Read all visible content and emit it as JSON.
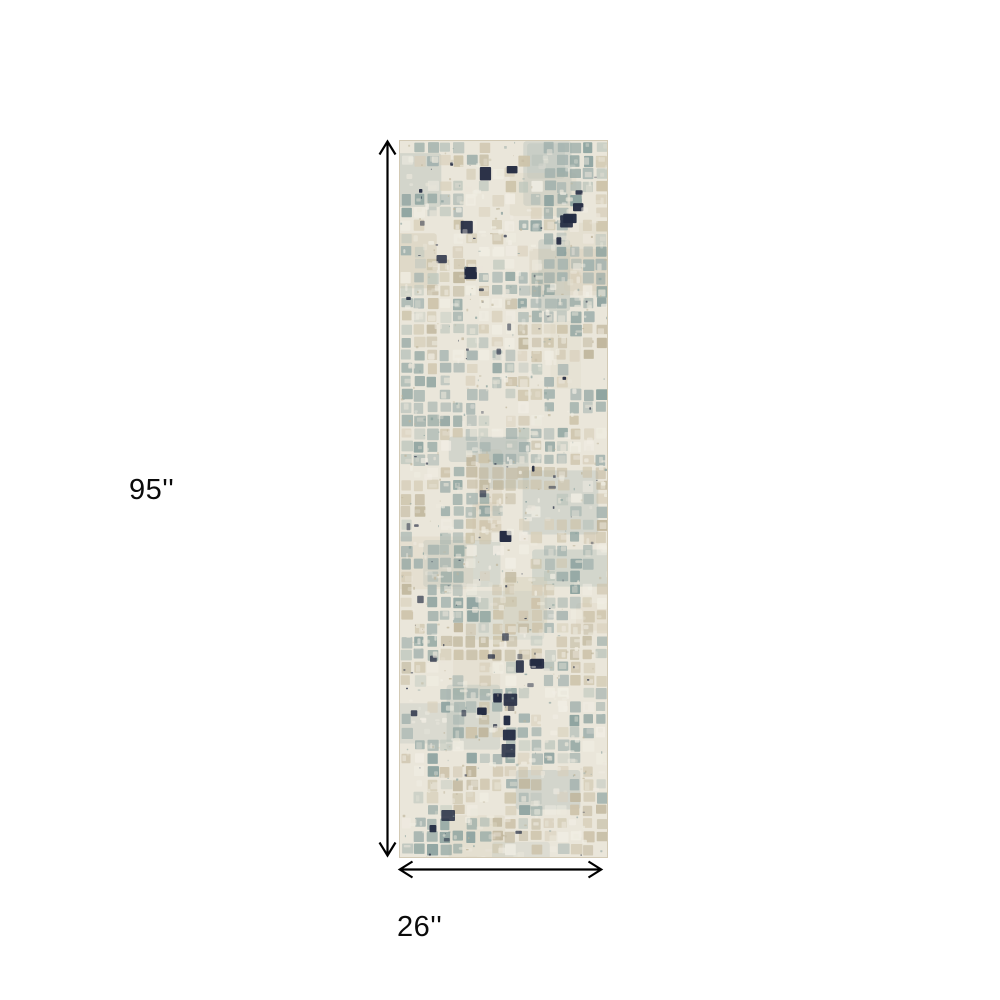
{
  "page": {
    "background": "#ffffff"
  },
  "diagram": {
    "height_label": "95''",
    "width_label": "26''",
    "arrow_color": "#000000",
    "label_color": "#0b0b0b"
  },
  "rug": {
    "description": "abstract distressed mosaic runner rug",
    "colors": {
      "ivory": "#eae6da",
      "ivory_light": "#f1eee4",
      "taupe": "#d8cfba",
      "beige": "#cdc3aa",
      "beige_dark": "#bfb59b",
      "sage": "#a3b2ae",
      "sage_dark": "#8ba19e",
      "sage_light": "#bcc5bc",
      "navy": "#232b42",
      "border": "#d3cab5"
    }
  }
}
